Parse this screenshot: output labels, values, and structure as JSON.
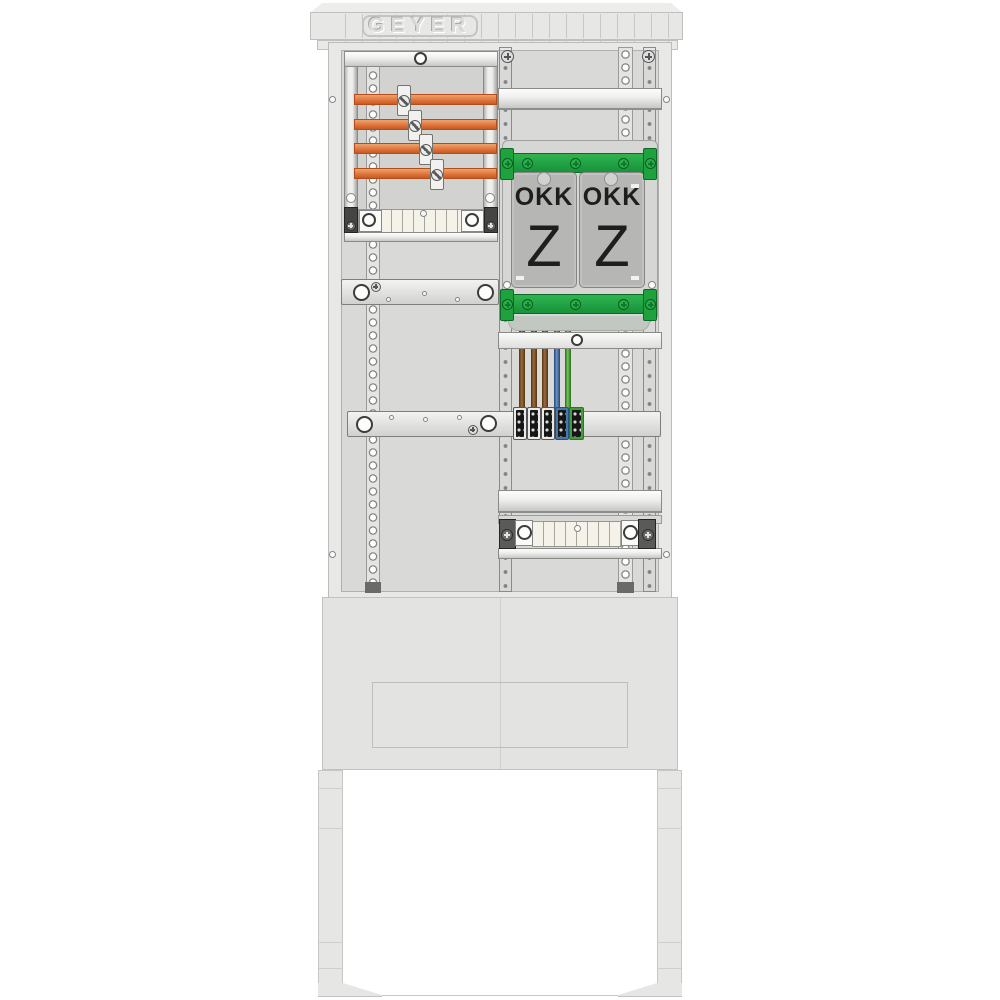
{
  "brand": {
    "logo_text": "GEYER"
  },
  "meter_covers": [
    {
      "title": "OKK",
      "letter": "Z"
    },
    {
      "title": "OKK",
      "letter": "Z"
    }
  ],
  "components": {
    "busbars": {
      "count": 4,
      "color": "#d96b33"
    },
    "busbar_clamps": {
      "count": 4
    },
    "green_rails": {
      "count": 2,
      "color": "#1fa23e"
    },
    "wires": [
      {
        "color_name": "brown",
        "hex": "#7a4e24"
      },
      {
        "color_name": "brown",
        "hex": "#7a4e24"
      },
      {
        "color_name": "brown",
        "hex": "#7a4e24"
      },
      {
        "color_name": "blue",
        "hex": "#4878aa"
      },
      {
        "color_name": "green",
        "hex": "#3f9e38"
      }
    ],
    "terminal_blocks": [
      {
        "body_color": "gray"
      },
      {
        "body_color": "gray"
      },
      {
        "body_color": "gray"
      },
      {
        "body_color": "blue"
      },
      {
        "body_color": "green"
      }
    ]
  },
  "colors": {
    "background": "#ffffff",
    "cabinet_shell": "#e7e7e5",
    "mounting_panel": "#d9d9d7",
    "cover_plate": "#b6b6b4",
    "busbar_orange": "#d96b33",
    "rail_green": "#1fa23e"
  },
  "icons": {
    "screw_cross": "+",
    "screw_slot": "/",
    "ring_hole": "o"
  }
}
